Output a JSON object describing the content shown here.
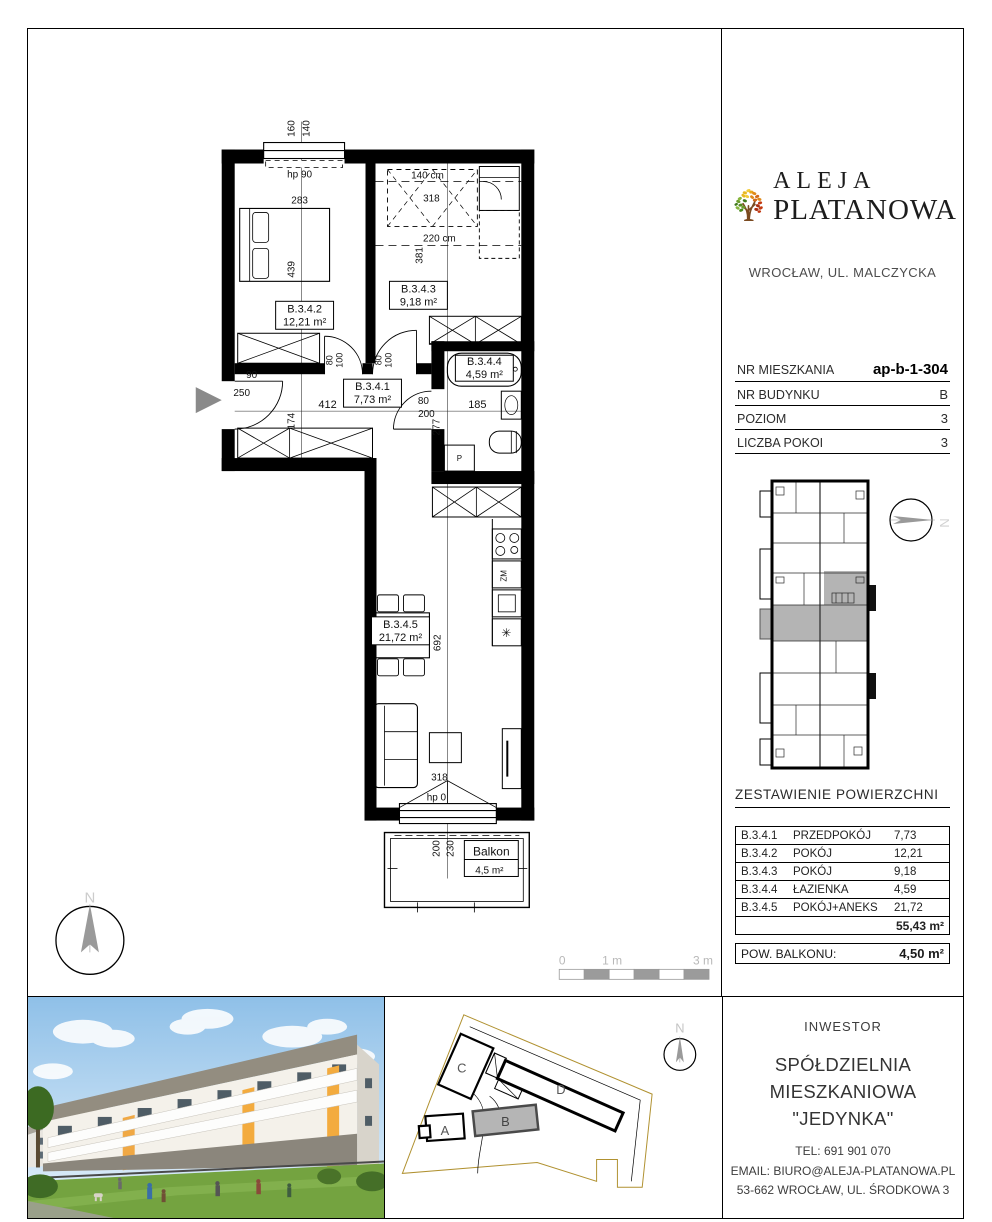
{
  "plan": {
    "labels": [
      {
        "t": "160",
        "x": 267,
        "y": 99,
        "r": -90,
        "s": 10
      },
      {
        "t": "140",
        "x": 282,
        "y": 99,
        "r": -90,
        "s": 10
      },
      {
        "t": "hp 90",
        "x": 272,
        "y": 148,
        "s": 10
      },
      {
        "t": "283",
        "x": 272,
        "y": 174,
        "s": 10
      },
      {
        "t": "439",
        "x": 267,
        "y": 240,
        "r": -90,
        "s": 10
      },
      {
        "t": "B.3.4.2",
        "x": 277,
        "y": 283,
        "s": 11
      },
      {
        "t": "12,21 m²",
        "x": 277,
        "y": 296,
        "s": 11
      },
      {
        "t": "140 cm",
        "x": 400,
        "y": 149,
        "s": 10
      },
      {
        "t": "318",
        "x": 404,
        "y": 172,
        "s": 10
      },
      {
        "t": "220 cm",
        "x": 412,
        "y": 212,
        "s": 10
      },
      {
        "t": "381",
        "x": 395,
        "y": 226,
        "r": -90,
        "s": 10
      },
      {
        "t": "B.3.4.3",
        "x": 391,
        "y": 263,
        "s": 11
      },
      {
        "t": "9,18 m²",
        "x": 391,
        "y": 276,
        "s": 11
      },
      {
        "t": "80",
        "x": 305,
        "y": 331,
        "r": -90,
        "s": 9
      },
      {
        "t": "100",
        "x": 315,
        "y": 331,
        "r": -90,
        "s": 9
      },
      {
        "t": "80",
        "x": 354,
        "y": 331,
        "r": -90,
        "s": 9
      },
      {
        "t": "100",
        "x": 364,
        "y": 331,
        "r": -90,
        "s": 9
      },
      {
        "t": "90",
        "x": 224,
        "y": 349,
        "s": 10
      },
      {
        "t": "250",
        "x": 214,
        "y": 367,
        "s": 10
      },
      {
        "t": "B.3.4.1",
        "x": 345,
        "y": 361,
        "s": 11
      },
      {
        "t": "7,73 m²",
        "x": 345,
        "y": 374,
        "s": 11
      },
      {
        "t": "412",
        "x": 300,
        "y": 379,
        "s": 11
      },
      {
        "t": "174",
        "x": 267,
        "y": 392,
        "r": -90,
        "s": 10
      },
      {
        "t": "80",
        "x": 396,
        "y": 375,
        "s": 10
      },
      {
        "t": "200",
        "x": 399,
        "y": 388,
        "s": 10
      },
      {
        "t": "277",
        "x": 412,
        "y": 398,
        "r": -90,
        "s": 10
      },
      {
        "t": "B.3.4.4",
        "x": 457,
        "y": 336,
        "s": 11
      },
      {
        "t": "4,59 m²",
        "x": 457,
        "y": 349,
        "s": 11
      },
      {
        "t": "185",
        "x": 450,
        "y": 379,
        "s": 11
      },
      {
        "t": "P",
        "x": 432,
        "y": 432,
        "s": 8
      },
      {
        "t": "ZM",
        "x": 479,
        "y": 547,
        "r": -90,
        "s": 8
      },
      {
        "t": "✳",
        "x": 479,
        "y": 608,
        "s": 12
      },
      {
        "t": "B.3.4.5",
        "x": 373,
        "y": 599,
        "s": 11
      },
      {
        "t": "21,72 m²",
        "x": 373,
        "y": 612,
        "s": 11
      },
      {
        "t": "692",
        "x": 413,
        "y": 614,
        "r": -90,
        "s": 10
      },
      {
        "t": "318",
        "x": 412,
        "y": 752,
        "s": 10
      },
      {
        "t": "hp 0",
        "x": 409,
        "y": 772,
        "s": 10
      },
      {
        "t": "200",
        "x": 412,
        "y": 820,
        "r": -90,
        "s": 10
      },
      {
        "t": "230",
        "x": 426,
        "y": 820,
        "r": -90,
        "s": 10
      },
      {
        "t": "Balkon",
        "x": 464,
        "y": 827,
        "s": 12
      },
      {
        "t": "4,5 m²",
        "x": 462,
        "y": 845,
        "s": 10
      },
      {
        "t": "N",
        "x": 62,
        "y": 874,
        "s": 15,
        "c": "#cccccc"
      },
      {
        "t": "0",
        "x": 535,
        "y": 936,
        "s": 12,
        "c": "#b8b8b8"
      },
      {
        "t": "1 m",
        "x": 585,
        "y": 936,
        "s": 12,
        "c": "#b8b8b8"
      },
      {
        "t": "3 m",
        "x": 676,
        "y": 936,
        "s": 12,
        "c": "#b8b8b8"
      }
    ]
  },
  "sidebar": {
    "logo": {
      "line1": "ALEJA",
      "line2": "PLATANOWA",
      "location": "WROCŁAW, UL. MALCZYCKA"
    },
    "details": [
      {
        "label": "NR MIESZKANIA",
        "value": "ap-b-1-304"
      },
      {
        "label": "NR BUDYNKU",
        "value": "B"
      },
      {
        "label": "POZIOM",
        "value": "3"
      },
      {
        "label": "LICZBA POKOI",
        "value": "3"
      }
    ],
    "areas_title": "ZESTAWIENIE POWIERZCHNI",
    "areas": [
      {
        "code": "B.3.4.1",
        "name": "PRZEDPOKÓJ",
        "area": "7,73"
      },
      {
        "code": "B.3.4.2",
        "name": "POKÓJ",
        "area": "12,21"
      },
      {
        "code": "B.3.4.3",
        "name": "POKÓJ",
        "area": "9,18"
      },
      {
        "code": "B.3.4.4",
        "name": "ŁAZIENKA",
        "area": "4,59"
      },
      {
        "code": "B.3.4.5",
        "name": "POKÓJ+ANEKS",
        "area": "21,72"
      }
    ],
    "total_area": "55,43 m²",
    "balcony_label": "POW. BALKONU:",
    "balcony_area": "4,50 m²",
    "minimap_labels": [
      {
        "t": "N",
        "x": 57,
        "y": 36,
        "r": 90,
        "s": 13,
        "c": "#d2d2d2"
      }
    ]
  },
  "footer": {
    "investor_heading": "INWESTOR",
    "investor_name_1": "SPÓŁDZIELNIA",
    "investor_name_2": "MIESZKANIOWA \"JEDYNKA\"",
    "tel": "TEL:  691 901 070",
    "email": "EMAIL: BIURO@ALEJA-PLATANOWA.PL",
    "address": "53-662 WROCŁAW, UL. ŚRODKOWA 3",
    "siteplan_labels": [
      {
        "t": "C",
        "x": 76,
        "y": 76,
        "s": 13,
        "c": "#555555"
      },
      {
        "t": "A",
        "x": 59,
        "y": 139,
        "s": 13,
        "c": "#555555"
      },
      {
        "t": "B",
        "x": 120,
        "y": 130,
        "s": 13,
        "c": "#444444"
      },
      {
        "t": "D",
        "x": 176,
        "y": 98,
        "s": 13,
        "c": "#555555"
      },
      {
        "t": "N",
        "x": 296,
        "y": 36,
        "s": 13,
        "c": "#c4c4c4"
      }
    ]
  }
}
